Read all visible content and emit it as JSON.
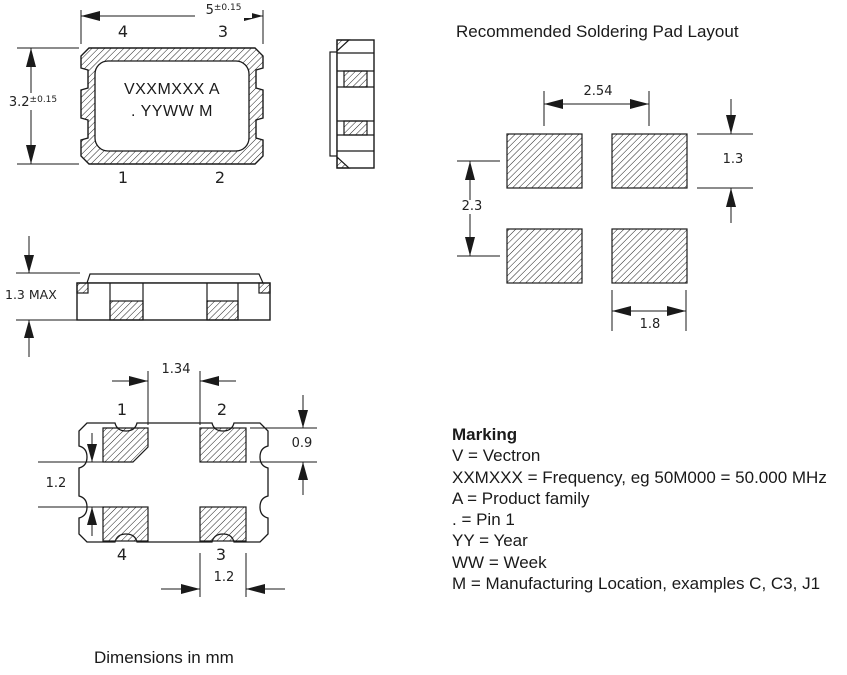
{
  "title": "Recommended Soldering Pad Layout",
  "footer": "Dimensions in mm",
  "top_view": {
    "dim_width": "5",
    "dim_width_tol": "±0.15",
    "dim_height": "3.2",
    "dim_height_tol": "±0.15",
    "marking_line1": "VXXMXXX A",
    "marking_line2": ". YYWW M",
    "pins": {
      "top_left": "4",
      "top_right": "3",
      "bottom_left": "1",
      "bottom_right": "2"
    }
  },
  "side_view": {
    "dim_height": "1.3 MAX"
  },
  "bottom_view": {
    "dim_pad_gap": "1.34",
    "dim_pad_height": "0.9",
    "dim_row_gap": "1.2",
    "dim_pad_width": "1.2",
    "pins": {
      "top_left": "1",
      "top_right": "2",
      "bottom_left": "4",
      "bottom_right": "3"
    }
  },
  "pad_layout": {
    "dim_pitch_x": "2.54",
    "dim_pitch_y": "2.3",
    "dim_pad_height": "1.3",
    "dim_pad_width": "1.8"
  },
  "marking": {
    "heading": "Marking",
    "lines": [
      "V = Vectron",
      "XXMXXX = Frequency, eg 50M000 = 50.000 MHz",
      "A = Product family",
      ". = Pin 1",
      "YY = Year",
      "WW = Week",
      "M = Manufacturing Location, examples C, C3, J1"
    ]
  }
}
